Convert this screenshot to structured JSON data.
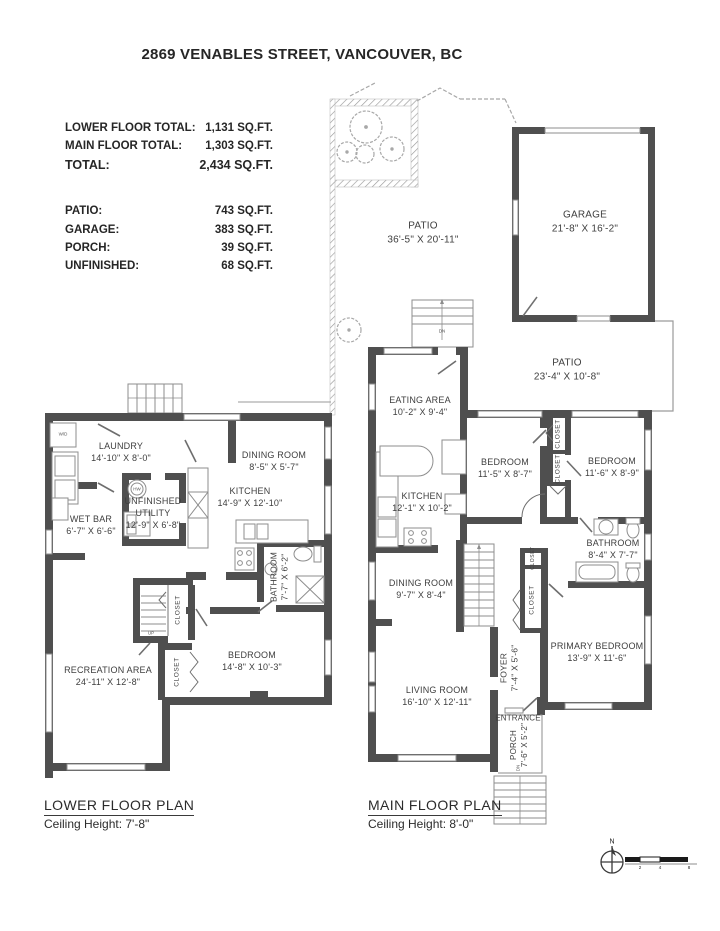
{
  "title": "2869 VENABLES STREET, VANCOUVER, BC",
  "stats": {
    "floor_rows": [
      {
        "label": "LOWER FLOOR TOTAL:",
        "value": "1,131 SQ.FT."
      },
      {
        "label": "MAIN FLOOR TOTAL:",
        "value": "1,303 SQ.FT."
      },
      {
        "label": "TOTAL:",
        "value": "2,434 SQ.FT."
      }
    ],
    "area_rows": [
      {
        "label": "PATIO:",
        "value": "743 SQ.FT."
      },
      {
        "label": "GARAGE:",
        "value": "383 SQ.FT."
      },
      {
        "label": "PORCH:",
        "value": "39 SQ.FT."
      },
      {
        "label": "UNFINISHED:",
        "value": "68 SQ.FT."
      }
    ]
  },
  "outdoor": {
    "patio_upper": {
      "name": "PATIO",
      "dims": "36'-5\" X 20'-11\""
    },
    "garage": {
      "name": "GARAGE",
      "dims": "21'-8\" X 16'-2\""
    },
    "patio_lower": {
      "name": "PATIO",
      "dims": "23'-4\" X 10'-8\""
    }
  },
  "lower_floor": {
    "plan_title": "LOWER FLOOR PLAN",
    "ceiling": "Ceiling Height: 7'-8\"",
    "rooms": {
      "laundry": {
        "name": "LAUNDRY",
        "dims": "14'-10\" X 8'-0\""
      },
      "dining": {
        "name": "DINING ROOM",
        "dims": "8'-5\" X 5'-7\""
      },
      "kitchen": {
        "name": "KITCHEN",
        "dims": "14'-9\" X 12'-10\""
      },
      "utility": {
        "name": "UNFINISHED UTILITY",
        "dims": "12'-9\" X 6'-8\""
      },
      "wet_bar": {
        "name": "WET BAR",
        "dims": "6'-7\" X 6'-6\""
      },
      "bathroom": {
        "name": "BATHROOM",
        "dims": "7'-7\" X 6'-2\""
      },
      "bedroom": {
        "name": "BEDROOM",
        "dims": "14'-8\" X 10'-3\""
      },
      "recreation": {
        "name": "RECREATION AREA",
        "dims": "24'-11\" X 12'-8\""
      },
      "closet_hall": {
        "name": "CLOSET"
      },
      "closet_bedroom": {
        "name": "CLOSET"
      }
    },
    "labels": {
      "up": "UP",
      "wd": "W/D",
      "hw": "HW"
    }
  },
  "main_floor": {
    "plan_title": "MAIN FLOOR PLAN",
    "ceiling": "Ceiling Height: 8'-0\"",
    "rooms": {
      "eating": {
        "name": "EATING AREA",
        "dims": "10'-2\" X 9'-4\""
      },
      "kitchen": {
        "name": "KITCHEN",
        "dims": "12'-1\" X 10'-2\""
      },
      "bedroom1": {
        "name": "BEDROOM",
        "dims": "11'-5\" X 8'-7\""
      },
      "bedroom2": {
        "name": "BEDROOM",
        "dims": "11'-6\" X 8'-9\""
      },
      "bathroom": {
        "name": "BATHROOM",
        "dims": "8'-4\" X 7'-7\""
      },
      "primary": {
        "name": "PRIMARY BEDROOM",
        "dims": "13'-9\" X 11'-6\""
      },
      "dining": {
        "name": "DINING ROOM",
        "dims": "9'-7\" X 8'-4\""
      },
      "living": {
        "name": "LIVING ROOM",
        "dims": "16'-10\" X 12'-11\""
      },
      "foyer": {
        "name": "FOYER",
        "dims": "7'-4\" X 5'-6\""
      },
      "entrance": {
        "name": "ENTRANCE"
      },
      "porch": {
        "name": "PORCH",
        "dims": "7'-6\" X 5'-2\""
      },
      "closet_a": {
        "name": "CLOSET"
      },
      "closet_b": {
        "name": "CLOSET"
      },
      "closet_small": {
        "name": "CLOSET"
      },
      "closet_foyer": {
        "name": "CLOSET"
      }
    },
    "labels": {
      "dn": "DN"
    }
  },
  "compass": {
    "north": "N"
  },
  "scale": {
    "ticks": [
      "2",
      "4",
      "8"
    ]
  },
  "colors": {
    "wall": "#4f4f4f",
    "thin_line": "#8d8d8d",
    "light_line": "#aeaeae",
    "text": "#3e3e3e"
  }
}
